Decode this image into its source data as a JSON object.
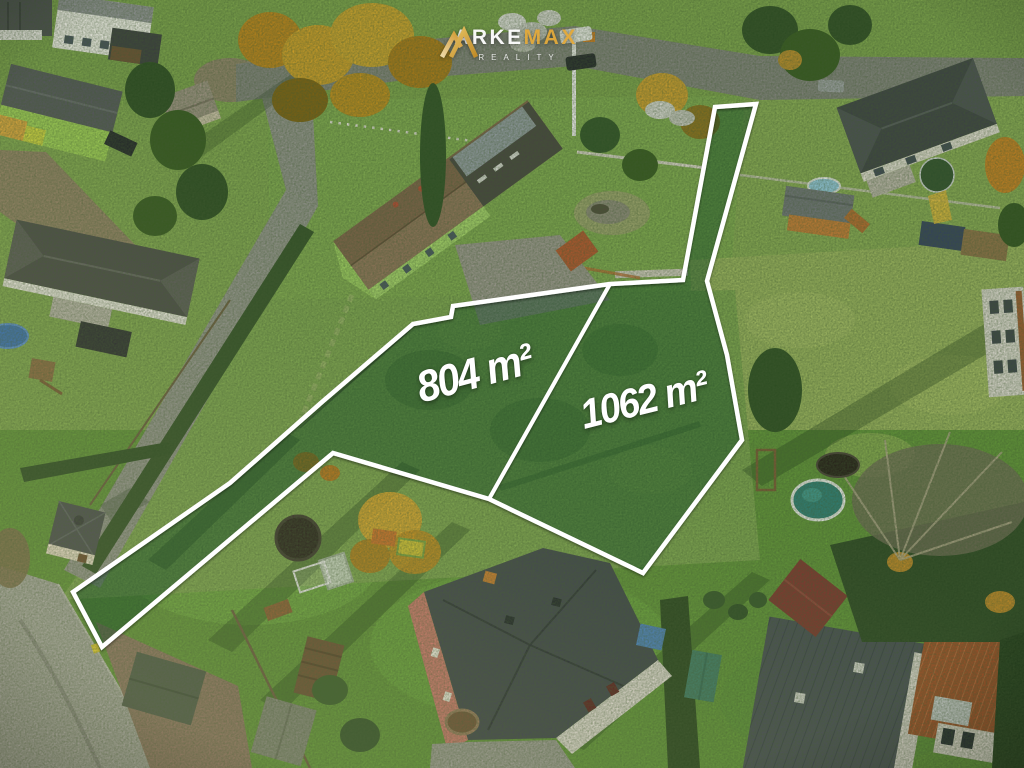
{
  "watermark": {
    "brand_primary": "ARKE",
    "brand_secondary": "MAX",
    "brand_sub": "REALITY",
    "gold_color": "#e2a93b",
    "text_color": "#ffffff"
  },
  "plots": [
    {
      "area_label": "804 m²",
      "area_m2": 804
    },
    {
      "area_label": "1062 m²",
      "area_m2": 1062
    }
  ],
  "overlay": {
    "boundary_color": "#ffffff",
    "tint_color": "rgba(15,70,35,0.40)"
  }
}
